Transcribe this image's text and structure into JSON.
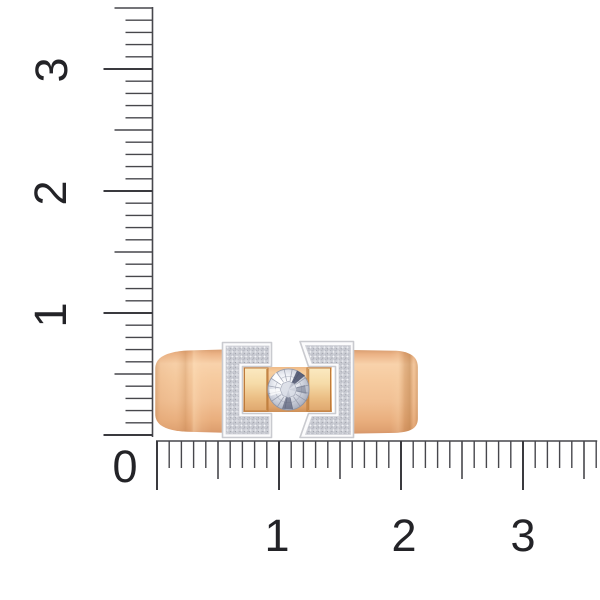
{
  "scene": {
    "description": "Rose-gold ring with white-gold pave diamond brackets and a central round brilliant diamond, shown on a white background beside centimeter rulers",
    "background_color": "#ffffff"
  },
  "rulers": {
    "unit": "cm",
    "tick_color": "#47474C",
    "major_tick_color": "#3A3A3F",
    "label_color": "#232327",
    "minor_step_px": 12.2,
    "tick_lengths_px": {
      "minor": 27,
      "half": 38,
      "major": 49
    },
    "vertical": {
      "baseline_x": 152.5,
      "zero_y": 435,
      "tick_count": 36,
      "labels": [
        {
          "text": "1",
          "x": 51,
          "y": 315
        },
        {
          "text": "2",
          "x": 51,
          "y": 193
        },
        {
          "text": "3",
          "x": 52,
          "y": 70
        }
      ]
    },
    "horizontal": {
      "baseline_y": 441,
      "zero_x": 157,
      "tick_count": 37,
      "labels": [
        {
          "text": "1",
          "x": 277,
          "y": 536
        },
        {
          "text": "2",
          "x": 404,
          "y": 536
        },
        {
          "text": "3",
          "x": 523,
          "y": 536
        }
      ]
    },
    "origin_label": {
      "text": "0",
      "x": 125,
      "y": 467
    }
  },
  "ring": {
    "colors": {
      "band_gold": "#F3C79E",
      "band_gold_light": "#F8D2AB",
      "band_gold_dark": "#D6956A",
      "mount_gold": "#EEC08D",
      "prong_gold_light": "#FBE9C1",
      "prong_gold_dark": "#DFA76E",
      "prong_edge": "#BE7B3A",
      "metal_white": "#FBFBFC",
      "metal_outline": "#C9CACF",
      "pave_base": "#EDEEF2",
      "diamond_light": "#FFFFFF",
      "diamond_mid": "#CDD1DC",
      "diamond_dark": "#9296A6",
      "diamond_accent": "#3E4662"
    },
    "facet_spokes": 16
  }
}
